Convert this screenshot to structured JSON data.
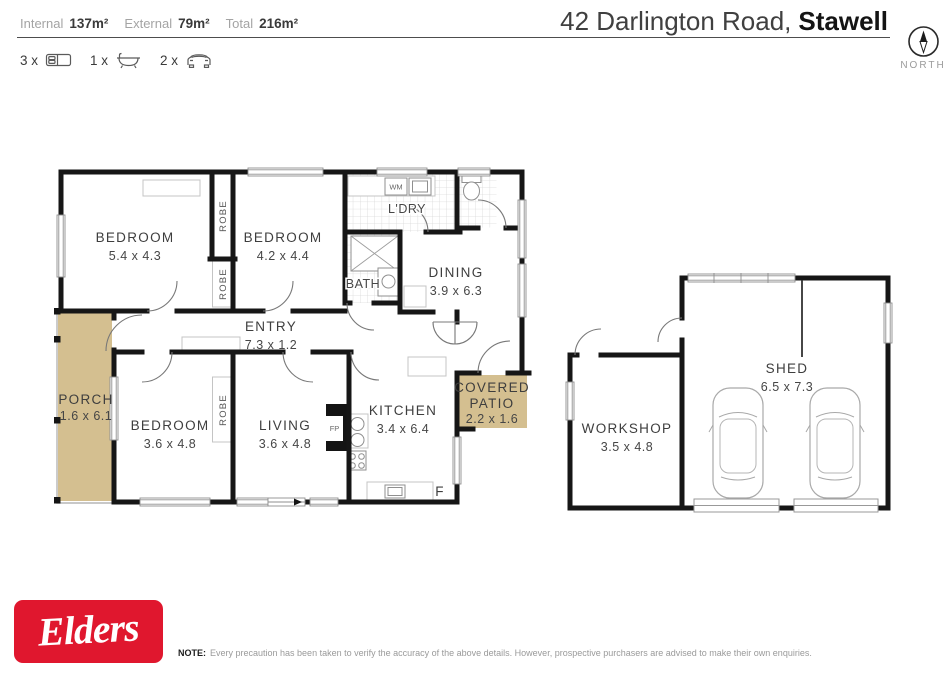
{
  "header": {
    "stats": [
      {
        "label": "Internal",
        "value": "137m²"
      },
      {
        "label": "External",
        "value": "79m²"
      },
      {
        "label": "Total",
        "value": "216m²"
      }
    ],
    "features": [
      {
        "count": "3 x",
        "icon": "bed-icon"
      },
      {
        "count": "1 x",
        "icon": "bath-icon"
      },
      {
        "count": "2 x",
        "icon": "car-icon"
      }
    ],
    "address": {
      "regular": "42 Darlington Road,",
      "bold": "Stawell"
    },
    "compass_label": "NORTH"
  },
  "rooms": {
    "bedroom1": {
      "name": "BEDROOM",
      "dims": "5.4 x 4.3"
    },
    "bedroom2": {
      "name": "BEDROOM",
      "dims": "4.2 x 4.4"
    },
    "bedroom3": {
      "name": "BEDROOM",
      "dims": "3.6 x 4.8"
    },
    "living": {
      "name": "LIVING",
      "dims": "3.6 x 4.8"
    },
    "kitchen": {
      "name": "KITCHEN",
      "dims": "3.4 x 6.4"
    },
    "dining": {
      "name": "DINING",
      "dims": "3.9 x 6.3"
    },
    "entry": {
      "name": "ENTRY",
      "dims": "7.3 x 1.2"
    },
    "porch": {
      "name": "PORCH",
      "dims": "1.6 x 6.1"
    },
    "patio": {
      "line1": "COVERED",
      "line2": "PATIO",
      "dims": "2.2 x 1.6"
    },
    "laundry": {
      "name": "L'DRY"
    },
    "bath": {
      "name": "BATH"
    },
    "workshop": {
      "name": "WORKSHOP",
      "dims": "3.5 x 4.8"
    },
    "shed": {
      "name": "SHED",
      "dims": "6.5 x 7.3"
    },
    "robe_label": "ROBE",
    "fixtures": {
      "wm": "WM",
      "fp": "FP",
      "fridge": "F"
    }
  },
  "footer": {
    "brand": "Elders",
    "note_label": "NOTE:",
    "note_text": "Every precaution has been taken to verify the accuracy of the above details. However, prospective purchasers are advised to make their own enquiries."
  },
  "colors": {
    "outdoor_tan": "#d4bf90",
    "brand_red": "#e0172e",
    "wall": "#161616"
  }
}
